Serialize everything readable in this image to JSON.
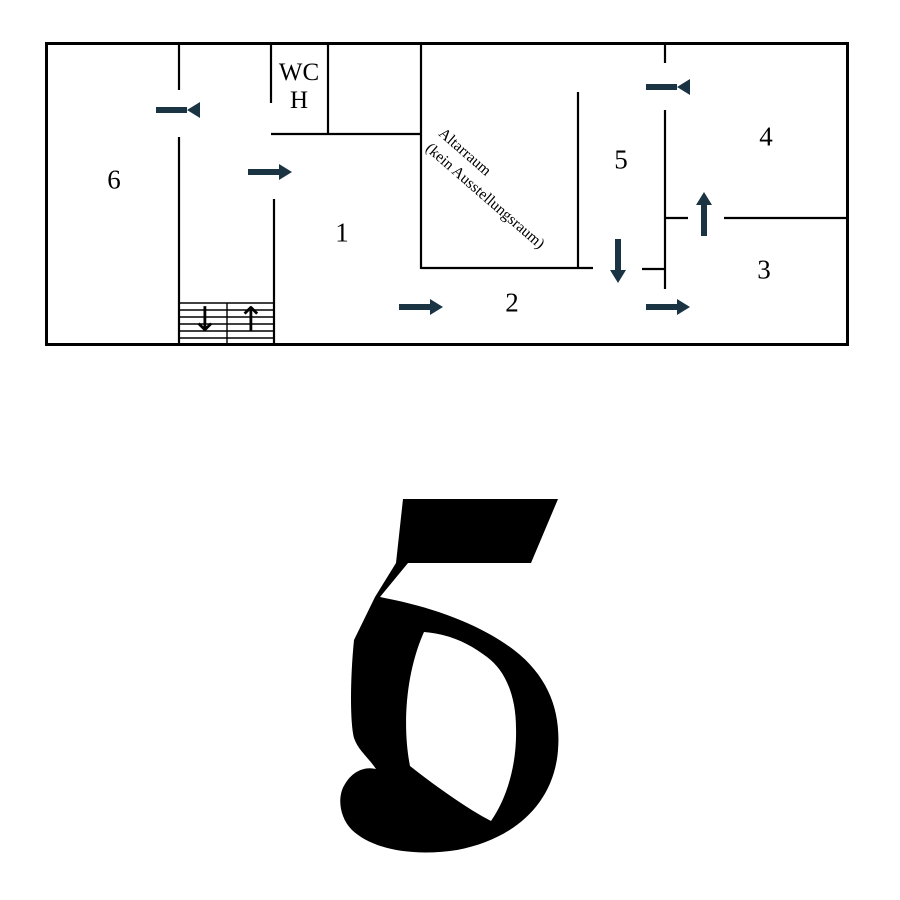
{
  "page": {
    "background": "#ffffff",
    "big_number": "5"
  },
  "floorplan": {
    "wall_color": "#000000",
    "arrow_color": "#1a3444",
    "rooms": {
      "r1": "1",
      "r2": "2",
      "r3": "3",
      "r4": "4",
      "r5": "5",
      "r6": "6"
    },
    "wc": {
      "line1": "WC",
      "line2": "H"
    },
    "altar": {
      "line1": "Altarraum",
      "line2": "(kein Ausstellungsraum)"
    },
    "stairs": {
      "down_symbol": "↓",
      "up_symbol": "↑"
    },
    "route_arrows": [
      {
        "id": "into-room-6",
        "direction": "left"
      },
      {
        "id": "into-room-1",
        "direction": "right"
      },
      {
        "id": "toward-room-2",
        "direction": "right"
      },
      {
        "id": "into-room-3",
        "direction": "right"
      },
      {
        "id": "out-of-room-5",
        "direction": "down"
      },
      {
        "id": "into-room-4",
        "direction": "up"
      },
      {
        "id": "into-room-5",
        "direction": "left"
      }
    ]
  }
}
